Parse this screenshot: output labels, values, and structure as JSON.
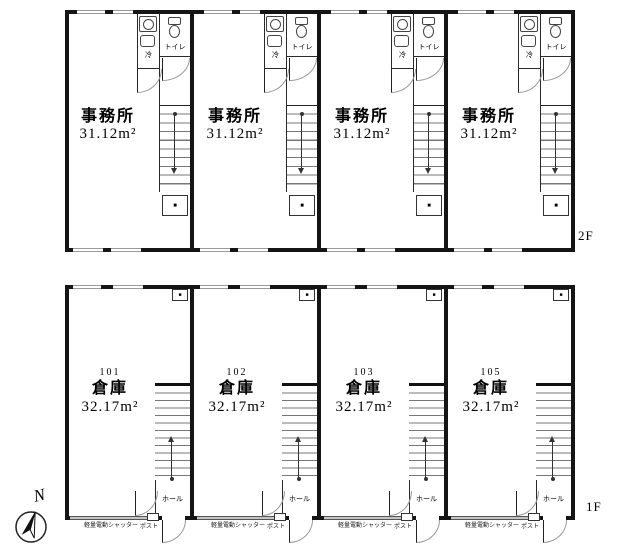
{
  "compass": {
    "label": "N"
  },
  "floor_2f": {
    "label": "2F",
    "units": [
      {
        "room_label": "事務所",
        "area": "31.12m²",
        "fridge_label": "冷",
        "toilet_label": "トイレ",
        "closet_glyph": "■"
      },
      {
        "room_label": "事務所",
        "area": "31.12m²",
        "fridge_label": "冷",
        "toilet_label": "トイレ",
        "closet_glyph": "■"
      },
      {
        "room_label": "事務所",
        "area": "31.12m²",
        "fridge_label": "冷",
        "toilet_label": "トイレ",
        "closet_glyph": "■"
      },
      {
        "room_label": "事務所",
        "area": "31.12m²",
        "fridge_label": "冷",
        "toilet_label": "トイレ",
        "closet_glyph": "■"
      }
    ]
  },
  "floor_1f": {
    "label": "1F",
    "units": [
      {
        "number": "101",
        "room_label": "倉庫",
        "area": "32.17m²",
        "hall_label": "ホール",
        "post_label": "ポスト",
        "shutter_label": "軽量電動シャッター",
        "meter_glyph": "■"
      },
      {
        "number": "102",
        "room_label": "倉庫",
        "area": "32.17m²",
        "hall_label": "ホール",
        "post_label": "ポスト",
        "shutter_label": "軽量電動シャッター",
        "meter_glyph": "■"
      },
      {
        "number": "103",
        "room_label": "倉庫",
        "area": "32.17m²",
        "hall_label": "ホール",
        "post_label": "ポスト",
        "shutter_label": "軽量電動シャッター",
        "meter_glyph": "■"
      },
      {
        "number": "105",
        "room_label": "倉庫",
        "area": "32.17m²",
        "hall_label": "ホール",
        "post_label": "ポスト",
        "shutter_label": "軽量電動シャッター",
        "meter_glyph": "■"
      }
    ]
  }
}
